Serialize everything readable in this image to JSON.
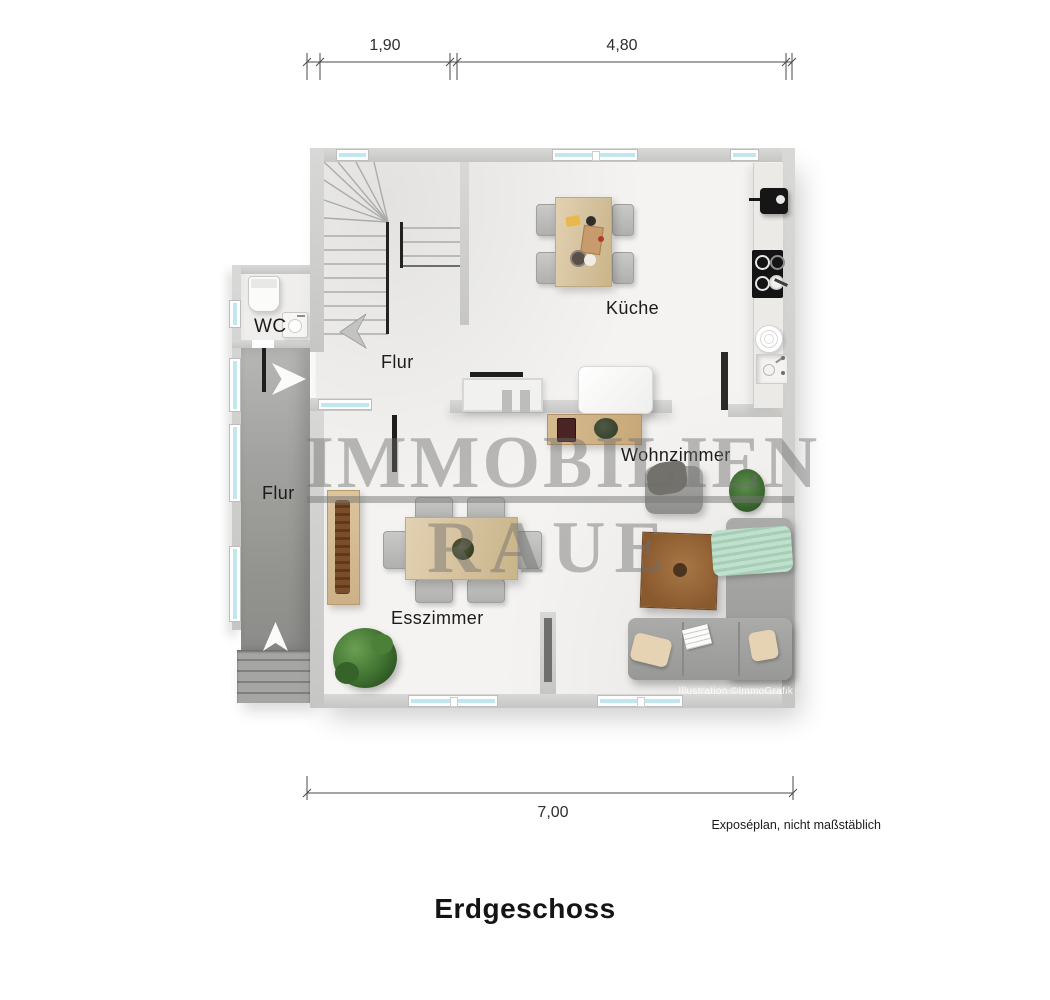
{
  "dimensions": {
    "top_left": "1,90",
    "top_right": "4,80",
    "bottom": "7,00"
  },
  "rooms": {
    "wc": "WC",
    "hall_main": "Flur",
    "hall_entry": "Flur",
    "kitchen": "Küche",
    "dining": "Esszimmer",
    "living": "Wohnzimmer"
  },
  "watermark": {
    "line1": "IMMOBILIEN",
    "line2": "RAUE"
  },
  "credit": "Illustration ©ImmoGrafik",
  "footer": {
    "disclaimer": "Exposéplan, nicht maßstäblich",
    "title": "Erdgeschoss"
  },
  "colors": {
    "wall": "#cdcdcb",
    "floor": "#f4f3f1",
    "concrete_hall": "#9e9e9c",
    "window_glass": "#bfe7ed",
    "wood_table": "#dcc9a8",
    "sofa_gray": "#a2a2a0",
    "blanket_mint": "#b5d9c4",
    "plant_green": "#477a3a",
    "appliance_black": "#1b1b1b"
  }
}
